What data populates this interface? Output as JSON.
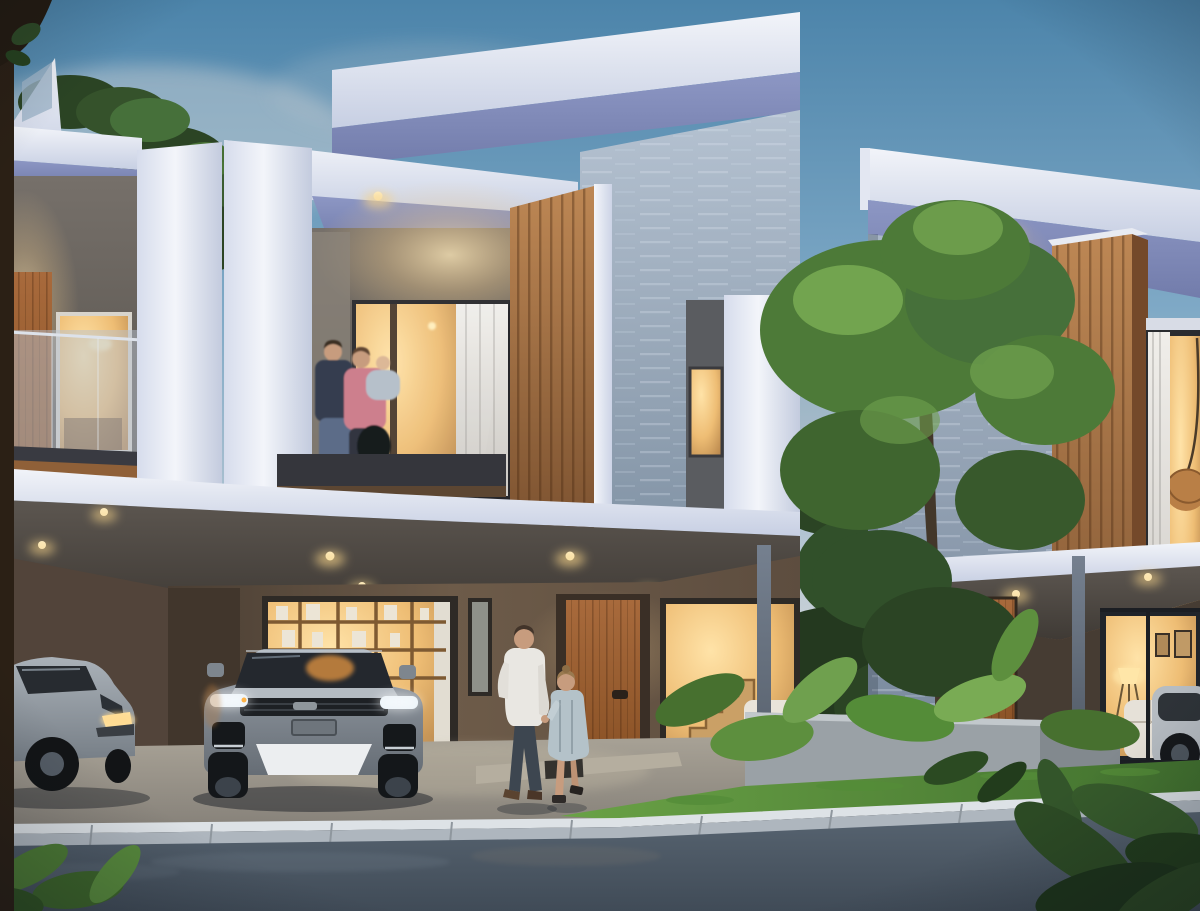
{
  "scene": {
    "title": "Modern townhouse row at dusk",
    "description": "Photorealistic architectural rendering of a row of modern two-storey townhouses at dusk with warm interior lighting: a family with a baby stands on the centre balcony, a man and a little girl walk hand in hand toward the timber entry door, a grey SUV and a silver sedan are parked in the carports, a tall garden tree and tropical plants sit in a concrete planter beside a lawn, with a light stone curb and asphalt street in the foreground",
    "time_of_day": "dusk",
    "weather": "clear",
    "counts": {
      "houses": 3,
      "people": 5,
      "vehicles": 3
    },
    "houses": [
      {
        "id": "left-house",
        "position": "left edge",
        "features": [
          "rooftop glass parapet",
          "upper balcony with frosted glass railing",
          "timber privacy panel",
          "warm lit windows",
          "carport with silver sedan"
        ]
      },
      {
        "id": "middle-house",
        "position": "centre",
        "features": [
          "white wrap-around frame",
          "tall rear blade wall with stone cladding",
          "vertical timber slat panel",
          "balcony with family",
          "cantilevered canopy with recessed downlights",
          "bookshelf window",
          "timber entry door",
          "stair window",
          "grey SUV in carport"
        ]
      },
      {
        "id": "right-house",
        "position": "right",
        "features": [
          "stone clad side wall",
          "timber box bay window with wicker lantern",
          "white roof band",
          "canopy on slim steel posts",
          "living room window with floor lamp and framed pictures",
          "concrete garden planter"
        ]
      }
    ],
    "people": [
      {
        "id": "balcony-man",
        "location": "middle house balcony",
        "appearance": "dark sweater and jeans"
      },
      {
        "id": "balcony-woman",
        "location": "middle house balcony",
        "appearance": "pink top, black bag, holding a baby"
      },
      {
        "id": "balcony-baby",
        "location": "middle house balcony",
        "appearance": "held in the woman's arms"
      },
      {
        "id": "walking-man",
        "location": "front walkway",
        "appearance": "white shirt and dark trousers, walking toward the door"
      },
      {
        "id": "walking-girl",
        "location": "front walkway",
        "appearance": "pale blue-grey dress, holding the man's hand"
      }
    ],
    "vehicles": [
      {
        "id": "suv",
        "type": "grey SUV",
        "location": "middle carport",
        "state": "parked facing the street, daytime running lights lit"
      },
      {
        "id": "sedan",
        "type": "silver sedan",
        "location": "left carport",
        "state": "parked at an angle"
      },
      {
        "id": "right-car",
        "type": "silver car",
        "location": "far right edge",
        "state": "partially visible"
      }
    ],
    "vegetation": [
      "background tree line",
      "rooftop shrubs",
      "tall garden tree between houses",
      "big-leaf tropical plants in planter",
      "lawn strip",
      "foreground leaves in bottom corners",
      "dark tree trunk at left edge"
    ],
    "ground": [
      "concrete driveway",
      "light stone curb",
      "asphalt street",
      "entry step with dark doormat"
    ],
    "lighting": [
      "recessed ceiling downlights",
      "warm glow from interior windows",
      "soffit downlight washing the stone wall",
      "floor lamp in right living room",
      "LED headlight strips on the SUV"
    ]
  },
  "palette": {
    "sky_top": "#4c84aa",
    "sky_mid": "#7fa9c6",
    "sky_horizon": "#c6cfd6",
    "cloud": "#c9cfd3",
    "white_hi": "#f2f4f9",
    "white_lo": "#c7cfe3",
    "soffit": "#8d97c4",
    "stone_hi": "#a9b7c7",
    "stone_lo": "#76869a",
    "wood_hi": "#bd8754",
    "wood_lo": "#7c5230",
    "door_wood": "#a86a3c",
    "recess_wall": "#76706a",
    "glow_warm": "#f3cd8e",
    "window_warm": "#eebd74",
    "ceiling_warm": "#5c5650",
    "carport_wall": "#6d5b49",
    "carport_dark": "#4a3e33",
    "concrete": "#a8a296",
    "steel": "#75808f",
    "curb": "#dde2e6",
    "curb_face": "#aeb6be",
    "asphalt_hi": "#5d6a77",
    "asphalt_lo": "#404b57",
    "grass_hi": "#6aa246",
    "grass_lo": "#41702e",
    "tree_hi": "#79ab54",
    "tree_mid": "#4d7a38",
    "tree_dark": "#2b4424",
    "trunk": "#2b2015",
    "car_silver": "#aab1b8",
    "suv_grey": "#9aa2ab",
    "led": "#e8f1f8",
    "headlight": "#ffd98e",
    "skin": "#c79c7e",
    "shirt": "#e9e7e2",
    "pants": "#3d4650",
    "dress": "#b4c2c9",
    "pink": "#cd7f8d",
    "navy": "#363c50",
    "denim": "#5c6c88"
  }
}
